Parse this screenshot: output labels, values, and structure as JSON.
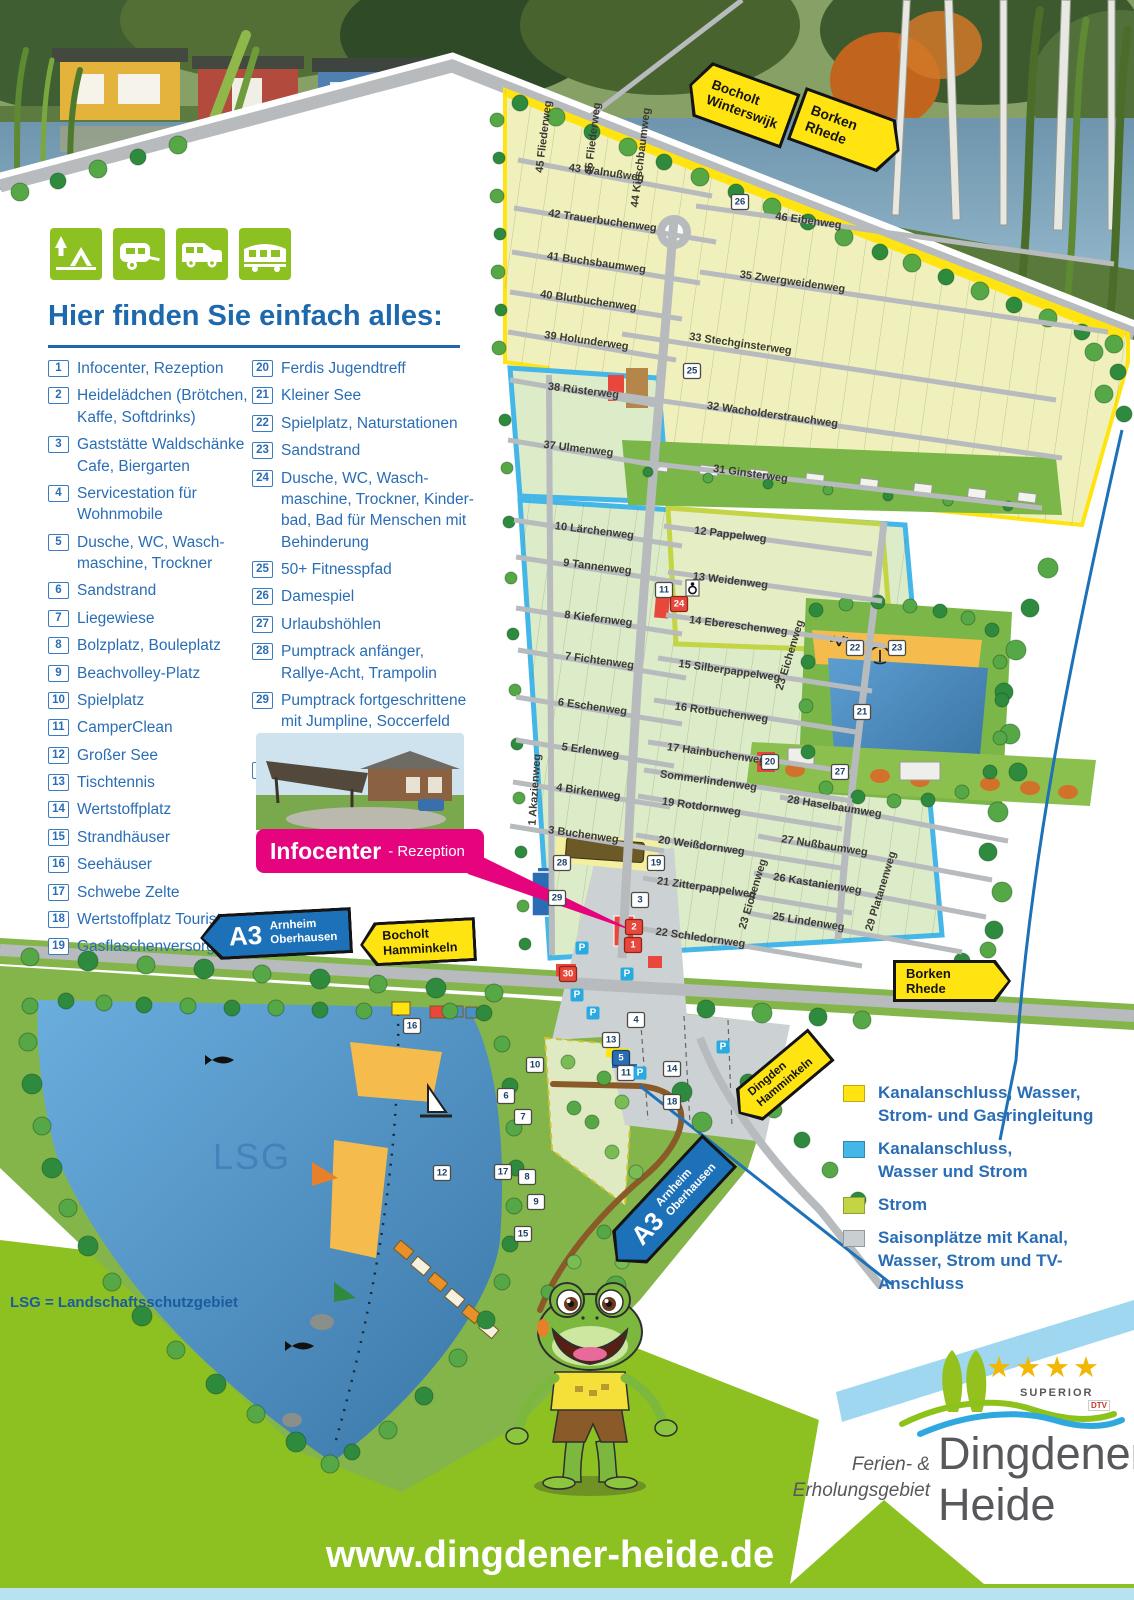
{
  "poster": {
    "url_banner": "www.dingdener-heide.de",
    "lsg_note": "LSG = Landschaftsschutzgebiet",
    "lake_label_big": "LSG"
  },
  "colors": {
    "brand_green": "#8dc021",
    "callout_pink": "#e5047e",
    "sign_yellow": "#ffe412",
    "sign_blue": "#1d71b8",
    "legend_blue": "#2a6db5",
    "lake_blue": "#4a90c8"
  },
  "header_icons": [
    "camping-tent-icon",
    "caravan-icon",
    "motorhome-icon",
    "mobile-home-icon"
  ],
  "legend": {
    "title": "Hier finden Sie einfach alles:",
    "items_left": [
      {
        "num": "1",
        "text": "Infocenter, Rezeption"
      },
      {
        "num": "2",
        "text": "Heidelädchen (Brötchen,\nKaffe, Softdrinks)"
      },
      {
        "num": "3",
        "text": "Gaststätte Waldschänke\nCafe, Biergarten"
      },
      {
        "num": "4",
        "text": "Servicestation für\nWohnmobile"
      },
      {
        "num": "5",
        "text": "Dusche, WC, Wasch-\nmaschine, Trockner"
      },
      {
        "num": "6",
        "text": "Sandstrand"
      },
      {
        "num": "7",
        "text": "Liegewiese"
      },
      {
        "num": "8",
        "text": "Bolzplatz, Bouleplatz"
      },
      {
        "num": "9",
        "text": "Beachvolley-Platz"
      },
      {
        "num": "10",
        "text": "Spielplatz"
      },
      {
        "num": "11",
        "text": "CamperClean"
      },
      {
        "num": "12",
        "text": "Großer See"
      },
      {
        "num": "13",
        "text": "Tischtennis"
      },
      {
        "num": "14",
        "text": "Wertstoffplatz"
      },
      {
        "num": "15",
        "text": "Strandhäuser"
      },
      {
        "num": "16",
        "text": "Seehäuser"
      },
      {
        "num": "17",
        "text": "Schwebe Zelte"
      },
      {
        "num": "18",
        "text": "Wertstoffplatz Touristen"
      },
      {
        "num": "19",
        "text": "Gasflaschenversorgung"
      }
    ],
    "items_right": [
      {
        "num": "20",
        "text": "Ferdis Jugendtreff"
      },
      {
        "num": "21",
        "text": "Kleiner See"
      },
      {
        "num": "22",
        "text": "Spielplatz, Naturstationen"
      },
      {
        "num": "23",
        "text": "Sandstrand"
      },
      {
        "num": "24",
        "text": "Dusche, WC, Wasch-\nmaschine, Trockner, Kinder-\nbad, Bad für Menschen mit\nBehinderung"
      },
      {
        "num": "25",
        "text": "50+ Fitnesspfad"
      },
      {
        "num": "26",
        "text": "Damespiel"
      },
      {
        "num": "27",
        "text": "Urlaubshöhlen"
      },
      {
        "num": "28",
        "text": "Pumptrack anfänger,\nRallye-Acht, Trampolin"
      },
      {
        "num": "29",
        "text": "Pumptrack fortgeschrittene\nmit Jumpline, Soccerfeld\nmit Basketball"
      },
      {
        "num": "30",
        "text": "Ferdis Bastelzentrale"
      }
    ]
  },
  "infocenter": {
    "label": "Infocenter",
    "sublabel": "- Rezeption"
  },
  "signs": {
    "bocholt_winterswijk": {
      "lines": [
        "Bocholt",
        "Winterswijk"
      ]
    },
    "borken_rhede_top": {
      "lines": [
        "Borken",
        "Rhede"
      ]
    },
    "a3_west": {
      "badge": "A3",
      "lines": [
        "Arnheim",
        "Oberhausen"
      ]
    },
    "bocholt_hamminkeln": {
      "lines": [
        "Bocholt",
        "Hamminkeln"
      ]
    },
    "borken_rhede_bottom": {
      "lines": [
        "Borken",
        "Rhede"
      ]
    },
    "dingden_hamminkeln": {
      "lines": [
        "Dingden",
        "Hamminkeln"
      ]
    },
    "a3_south": {
      "badge": "A3",
      "lines": [
        "Arnheim",
        "Oberhausen"
      ]
    }
  },
  "site_legend": [
    {
      "color": "#ffe412",
      "text": "Kanalanschluss, Wasser,\nStrom- und Gasringleitung"
    },
    {
      "color": "#45b6e8",
      "text": "Kanalanschluss,\nWasser und Strom"
    },
    {
      "color": "#c3d545",
      "text": "Strom"
    },
    {
      "color": "#c9ced0",
      "text": "Saisonplätze mit Kanal,\nWasser, Strom und TV-Anschluss"
    }
  ],
  "logo": {
    "stars": "★★★★",
    "superior": "SUPERIOR",
    "dtv": "DTV",
    "tagline": "Ferien- &\nErholungsgebiet",
    "name_line1": "Dingdener",
    "name_line2": "Heide"
  },
  "map": {
    "streets": [
      {
        "t": "45 Fliederweg",
        "x": 547,
        "y": 137,
        "r": -83
      },
      {
        "t": "45 Fliederweg",
        "x": 596,
        "y": 139,
        "r": -83
      },
      {
        "t": "44 Kirschbaumweg",
        "x": 644,
        "y": 158,
        "r": -83
      },
      {
        "t": "43 Walnußweg",
        "x": 606,
        "y": 176,
        "r": 8,
        "l": [
          518,
          160,
          712,
          196
        ]
      },
      {
        "t": "42 Trauerbuchenweg",
        "x": 602,
        "y": 224,
        "r": 8,
        "l": [
          514,
          208,
          716,
          242
        ]
      },
      {
        "t": "41 Buchsbaumweg",
        "x": 596,
        "y": 266,
        "r": 8,
        "l": [
          512,
          252,
          700,
          283
        ]
      },
      {
        "t": "40 Blutbuchenweg",
        "x": 588,
        "y": 304,
        "r": 8,
        "l": [
          510,
          292,
          682,
          319
        ]
      },
      {
        "t": "39 Holunderweg",
        "x": 586,
        "y": 344,
        "r": 8,
        "l": [
          508,
          332,
          676,
          360
        ]
      },
      {
        "t": "46 Eibenweg",
        "x": 808,
        "y": 224,
        "r": 8,
        "l": [
          696,
          206,
          1114,
          264
        ]
      },
      {
        "t": "35 Zwergweidenweg",
        "x": 792,
        "y": 285,
        "r": 8,
        "l": [
          700,
          272,
          1108,
          332
        ]
      },
      {
        "t": "33 Stechginsterweg",
        "x": 740,
        "y": 347,
        "r": 8,
        "l": [
          622,
          334,
          1056,
          400
        ]
      },
      {
        "t": "32 Wacholderstrauchweg",
        "x": 772,
        "y": 418,
        "r": 8,
        "l": [
          600,
          392,
          1062,
          458
        ]
      },
      {
        "t": "38 Rüsterweg",
        "x": 583,
        "y": 394,
        "r": 7,
        "l": [
          510,
          380,
          662,
          406
        ]
      },
      {
        "t": "37 Ulmenweg",
        "x": 578,
        "y": 452,
        "r": 7,
        "l": [
          508,
          440,
          660,
          466
        ]
      },
      {
        "t": "31 Ginsterweg",
        "x": 750,
        "y": 477,
        "r": 8,
        "l": [
          638,
          462,
          1042,
          508
        ]
      },
      {
        "t": "10 Lärchenweg",
        "x": 594,
        "y": 534,
        "r": 7,
        "l": [
          514,
          520,
          682,
          546
        ]
      },
      {
        "t": "12 Pappelweg",
        "x": 730,
        "y": 538,
        "r": 7,
        "l": [
          664,
          526,
          872,
          554
        ]
      },
      {
        "t": "9 Tannenweg",
        "x": 597,
        "y": 570,
        "r": 7,
        "l": [
          516,
          557,
          682,
          583
        ]
      },
      {
        "t": "13 Weidenweg",
        "x": 730,
        "y": 584,
        "r": 7,
        "l": [
          668,
          572,
          882,
          601
        ]
      },
      {
        "t": "8 Kiefernweg",
        "x": 598,
        "y": 622,
        "r": 7,
        "l": [
          516,
          608,
          682,
          634
        ]
      },
      {
        "t": "14 Ebereschenweg",
        "x": 738,
        "y": 629,
        "r": 7,
        "l": [
          666,
          615,
          886,
          646
        ]
      },
      {
        "t": "7 Fichtenweg",
        "x": 599,
        "y": 664,
        "r": 8,
        "l": [
          518,
          650,
          686,
          678
        ]
      },
      {
        "t": "15 Silberpappelweg",
        "x": 729,
        "y": 674,
        "r": 8,
        "l": [
          658,
          658,
          872,
          691
        ]
      },
      {
        "t": "6 Eschenweg",
        "x": 592,
        "y": 710,
        "r": 8,
        "l": [
          516,
          697,
          682,
          724
        ]
      },
      {
        "t": "16 Rotbuchenweg",
        "x": 721,
        "y": 716,
        "r": 8,
        "l": [
          654,
          700,
          862,
          733
        ]
      },
      {
        "t": "5 Erlenweg",
        "x": 590,
        "y": 754,
        "r": 8,
        "l": [
          516,
          740,
          674,
          766
        ]
      },
      {
        "t": "17 Hainbuchenweg",
        "x": 716,
        "y": 757,
        "r": 8,
        "l": [
          648,
          742,
          857,
          773
        ]
      },
      {
        "t": "Sommerlindenweg",
        "x": 708,
        "y": 784,
        "r": 8,
        "l": [
          644,
          770,
          852,
          801
        ]
      },
      {
        "t": "4 Birkenweg",
        "x": 588,
        "y": 795,
        "r": 8,
        "l": [
          513,
          782,
          670,
          807
        ]
      },
      {
        "t": "19 Rotdornweg",
        "x": 701,
        "y": 810,
        "r": 8,
        "l": [
          638,
          796,
          842,
          829
        ]
      },
      {
        "t": "3 Buchenweg",
        "x": 583,
        "y": 838,
        "r": 8,
        "l": [
          510,
          826,
          664,
          851
        ]
      },
      {
        "t": "20 Weißdornweg",
        "x": 701,
        "y": 849,
        "r": 8,
        "l": [
          636,
          835,
          847,
          869
        ]
      },
      {
        "t": "21 Zitterpappelweg",
        "x": 706,
        "y": 891,
        "r": 8,
        "l": [
          643,
          878,
          852,
          913
        ]
      },
      {
        "t": "22 Schledornweg",
        "x": 700,
        "y": 941,
        "r": 8,
        "l": [
          638,
          928,
          862,
          966
        ]
      },
      {
        "t": "28 Haselbaumweg",
        "x": 834,
        "y": 810,
        "r": 9,
        "l": [
          780,
          797,
          1008,
          841
        ]
      },
      {
        "t": "27 Nußbaumweg",
        "x": 824,
        "y": 849,
        "r": 9,
        "l": [
          758,
          836,
          992,
          880
        ]
      },
      {
        "t": "26 Kastanienweg",
        "x": 817,
        "y": 887,
        "r": 9,
        "l": [
          754,
          873,
          986,
          917
        ]
      },
      {
        "t": "25 Lindenweg",
        "x": 808,
        "y": 925,
        "r": 9,
        "l": [
          748,
          913,
          962,
          952
        ]
      },
      {
        "t": "23 Eichenweg",
        "x": 793,
        "y": 656,
        "r": -73
      },
      {
        "t": "23 Eichenweg",
        "x": 756,
        "y": 895,
        "r": -73
      },
      {
        "t": "29 Platanenweg",
        "x": 884,
        "y": 892,
        "r": -73
      },
      {
        "t": "1 Akazienweg",
        "x": 538,
        "y": 790,
        "r": -86
      }
    ],
    "markers": [
      {
        "n": "26",
        "x": 740,
        "y": 202,
        "c": "w"
      },
      {
        "n": "25",
        "x": 692,
        "y": 371,
        "c": "w"
      },
      {
        "n": "11",
        "x": 664,
        "y": 590,
        "c": "w"
      },
      {
        "n": "24",
        "x": 679,
        "y": 604,
        "c": "r"
      },
      {
        "n": "22",
        "x": 855,
        "y": 648,
        "c": "w"
      },
      {
        "n": "23",
        "x": 897,
        "y": 648,
        "c": "w"
      },
      {
        "n": "21",
        "x": 862,
        "y": 712,
        "c": "w"
      },
      {
        "n": "20",
        "x": 770,
        "y": 762,
        "c": "w"
      },
      {
        "n": "27",
        "x": 840,
        "y": 772,
        "c": "w"
      },
      {
        "n": "28",
        "x": 562,
        "y": 863,
        "c": "w"
      },
      {
        "n": "19",
        "x": 656,
        "y": 863,
        "c": "w"
      },
      {
        "n": "29",
        "x": 557,
        "y": 898,
        "c": "w"
      },
      {
        "n": "3",
        "x": 640,
        "y": 900,
        "c": "w"
      },
      {
        "n": "2",
        "x": 634,
        "y": 927,
        "c": "r"
      },
      {
        "n": "1",
        "x": 633,
        "y": 945,
        "c": "r"
      },
      {
        "n": "30",
        "x": 568,
        "y": 974,
        "c": "r"
      },
      {
        "n": "4",
        "x": 636,
        "y": 1020,
        "c": "w"
      },
      {
        "n": "16",
        "x": 412,
        "y": 1026,
        "c": "w"
      },
      {
        "n": "13",
        "x": 611,
        "y": 1040,
        "c": "w"
      },
      {
        "n": "5",
        "x": 621,
        "y": 1058,
        "c": "b"
      },
      {
        "n": "10",
        "x": 535,
        "y": 1065,
        "c": "w"
      },
      {
        "n": "14",
        "x": 672,
        "y": 1069,
        "c": "w"
      },
      {
        "n": "11",
        "x": 626,
        "y": 1073,
        "c": "w"
      },
      {
        "n": "6",
        "x": 506,
        "y": 1096,
        "c": "w"
      },
      {
        "n": "18",
        "x": 672,
        "y": 1102,
        "c": "w"
      },
      {
        "n": "7",
        "x": 523,
        "y": 1117,
        "c": "w"
      },
      {
        "n": "17",
        "x": 503,
        "y": 1172,
        "c": "w"
      },
      {
        "n": "12",
        "x": 442,
        "y": 1173,
        "c": "w"
      },
      {
        "n": "8",
        "x": 527,
        "y": 1177,
        "c": "w"
      },
      {
        "n": "9",
        "x": 536,
        "y": 1202,
        "c": "w"
      },
      {
        "n": "15",
        "x": 523,
        "y": 1234,
        "c": "w"
      }
    ],
    "parking": [
      {
        "x": 582,
        "y": 948
      },
      {
        "x": 627,
        "y": 974
      },
      {
        "x": 577,
        "y": 995
      },
      {
        "x": 593,
        "y": 1013
      },
      {
        "x": 640,
        "y": 1073
      },
      {
        "x": 723,
        "y": 1047
      }
    ]
  }
}
